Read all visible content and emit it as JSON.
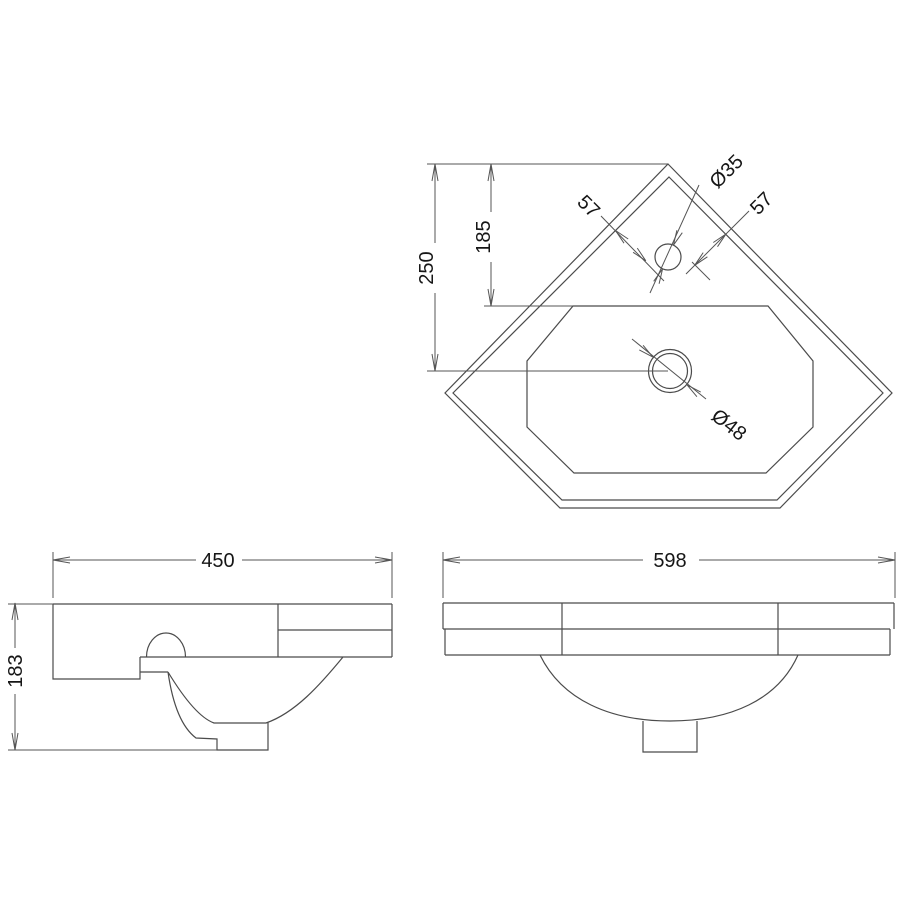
{
  "drawing": {
    "stroke_color": "#4b4b4b",
    "views": {
      "plan": {
        "dims": {
          "overall_height": "250",
          "tap_setback": "185",
          "tap_offset_left": "57",
          "tap_offset_right": "57",
          "tap_hole_diameter": "Ø35",
          "waste_diameter": "Ø48"
        }
      },
      "side": {
        "dims": {
          "depth": "450",
          "height": "183"
        }
      },
      "front": {
        "dims": {
          "width": "598"
        }
      }
    }
  }
}
